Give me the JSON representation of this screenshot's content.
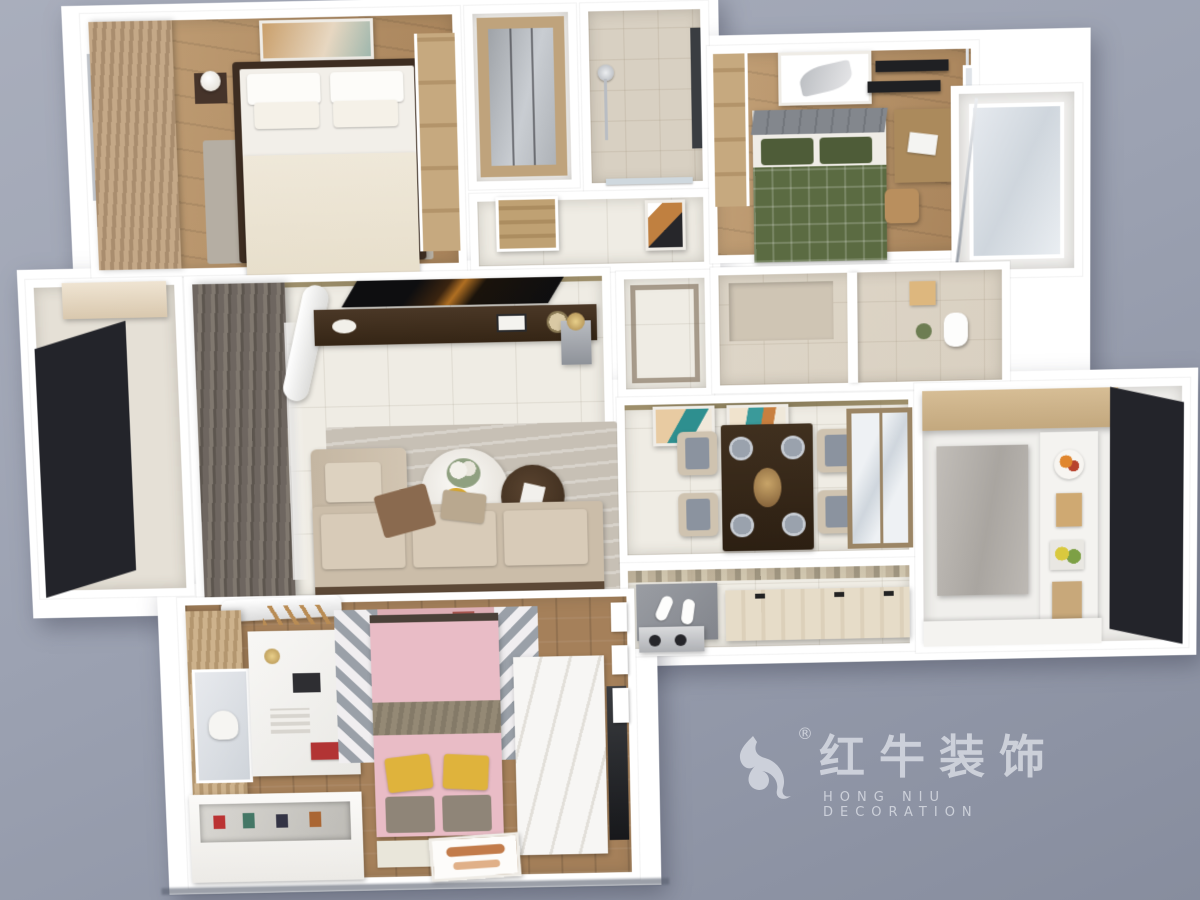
{
  "watermark": {
    "cn": "红牛装饰",
    "en": "HONG NIU DECORATION",
    "registered": "®"
  },
  "palette": {
    "bg_light": "#a9aebc",
    "bg": "#9ca2b2",
    "bg_dark": "#878d9e",
    "wall": "#ffffff",
    "tile": "#efece4",
    "marble": "#d9d0c1",
    "goldtrim": "#8f7d52",
    "bronze": "#9b8565",
    "chair": "#cfc3b0",
    "cushion": "#8b939f",
    "watermark": "#d8dbe3"
  },
  "scene": {
    "type": "3d-apartment-floorplan-render",
    "rooms": [
      {
        "name": "master-bedroom",
        "items": [
          "double-bed-white",
          "nightstands",
          "lamps",
          "artwork",
          "tan-curtains",
          "wardrobe"
        ]
      },
      {
        "name": "walk-in-closet",
        "items": [
          "mirror-wardrobe"
        ]
      },
      {
        "name": "shower-room",
        "items": [
          "shower-fixture",
          "beige-tiles"
        ]
      },
      {
        "name": "hallway",
        "items": [
          "wood-door",
          "abstract-artwork"
        ]
      },
      {
        "name": "second-bedroom",
        "items": [
          "green-plaid-bed",
          "gray-headboard",
          "feather-artwork",
          "desk-with-laptop",
          "black-shelves",
          "curtain-rod"
        ]
      },
      {
        "name": "bathroom",
        "items": [
          "toilet",
          "marble-tiles",
          "plant"
        ]
      },
      {
        "name": "living-room",
        "items": [
          "dark-curtains",
          "air-conditioner",
          "tv",
          "media-console",
          "l-shaped-sofa",
          "round-coffee-tables",
          "flowers",
          "rug"
        ]
      },
      {
        "name": "left-balcony",
        "items": [
          "black-frame-windows",
          "cabinet"
        ]
      },
      {
        "name": "dining-room",
        "items": [
          "dark-wood-table",
          "four-chairs",
          "plates",
          "two-artworks",
          "glass-sliding-door"
        ]
      },
      {
        "name": "entry",
        "items": [
          "doormat",
          "slippers",
          "shoe-bench",
          "cooktop"
        ]
      },
      {
        "name": "kitchen",
        "items": [
          "white-counters",
          "wood-cabinets",
          "marble-column",
          "fruit-plate",
          "black-frame-windows"
        ]
      },
      {
        "name": "kids-bedroom",
        "items": [
          "pink-bed",
          "yellow-pillows",
          "geometric-rug",
          "white-desk",
          "display-cabinet",
          "white-platform",
          "floor-artwork",
          "air-conditioner",
          "dark-doorway"
        ]
      }
    ]
  }
}
